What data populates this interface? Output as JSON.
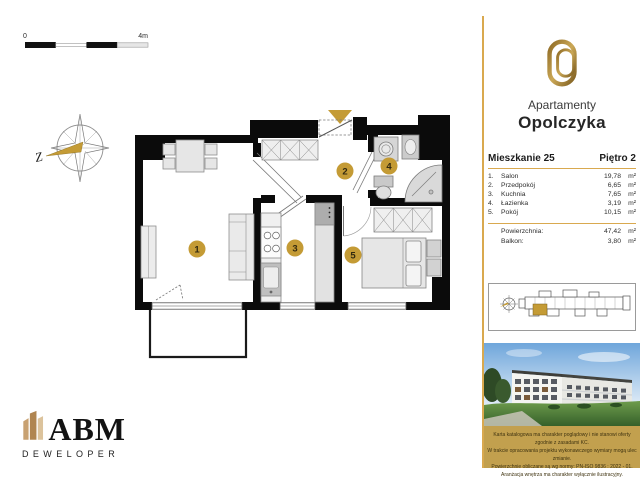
{
  "scale_bar": {
    "start_label": "0",
    "end_label": "4m"
  },
  "compass": {
    "west_label": "Z"
  },
  "brand": {
    "line1": "Apartamenty",
    "line2": "Opolczyka"
  },
  "unit_card": {
    "header_left": "Mieszkanie 25",
    "header_right": "Piętro 2",
    "rooms": [
      {
        "num": "1.",
        "name": "Salon",
        "area": "19,78",
        "unit": "m²"
      },
      {
        "num": "2.",
        "name": "Przedpokój",
        "area": "6,65",
        "unit": "m²"
      },
      {
        "num": "3.",
        "name": "Kuchnia",
        "area": "7,65",
        "unit": "m²"
      },
      {
        "num": "4.",
        "name": "Łazienka",
        "area": "3,19",
        "unit": "m²"
      },
      {
        "num": "5.",
        "name": "Pokój",
        "area": "10,15",
        "unit": "m²"
      }
    ],
    "totals": [
      {
        "label": "Powierzchnia:",
        "value": "47,42",
        "unit": "m²"
      },
      {
        "label": "Balkon:",
        "value": "3,80",
        "unit": "m²"
      }
    ]
  },
  "plan": {
    "room_labels": [
      "1",
      "2",
      "3",
      "4",
      "5"
    ]
  },
  "developer": {
    "name": "ABM",
    "subtitle": "DEWELOPER"
  },
  "disclaimer": {
    "line1": "Karta katalogowa ma charakter poglądowy i nie stanowi oferty zgodnie z zasadami KC.",
    "line2": "W trakcie opracowania projektu wykonawczego wymiary mogą ulec zmianie.",
    "line3": "Powierzchnie obliczane są wg normy: PN-ISO 9836 : 2022 - 01.",
    "line4": "Aranżacja wnętrza ma charakter wyłącznie ilustracyjny."
  },
  "colors": {
    "gold": "#C49B35",
    "gold_light": "#D9A94F",
    "band": "#C2A04E",
    "wall": "#0b0b0b"
  }
}
